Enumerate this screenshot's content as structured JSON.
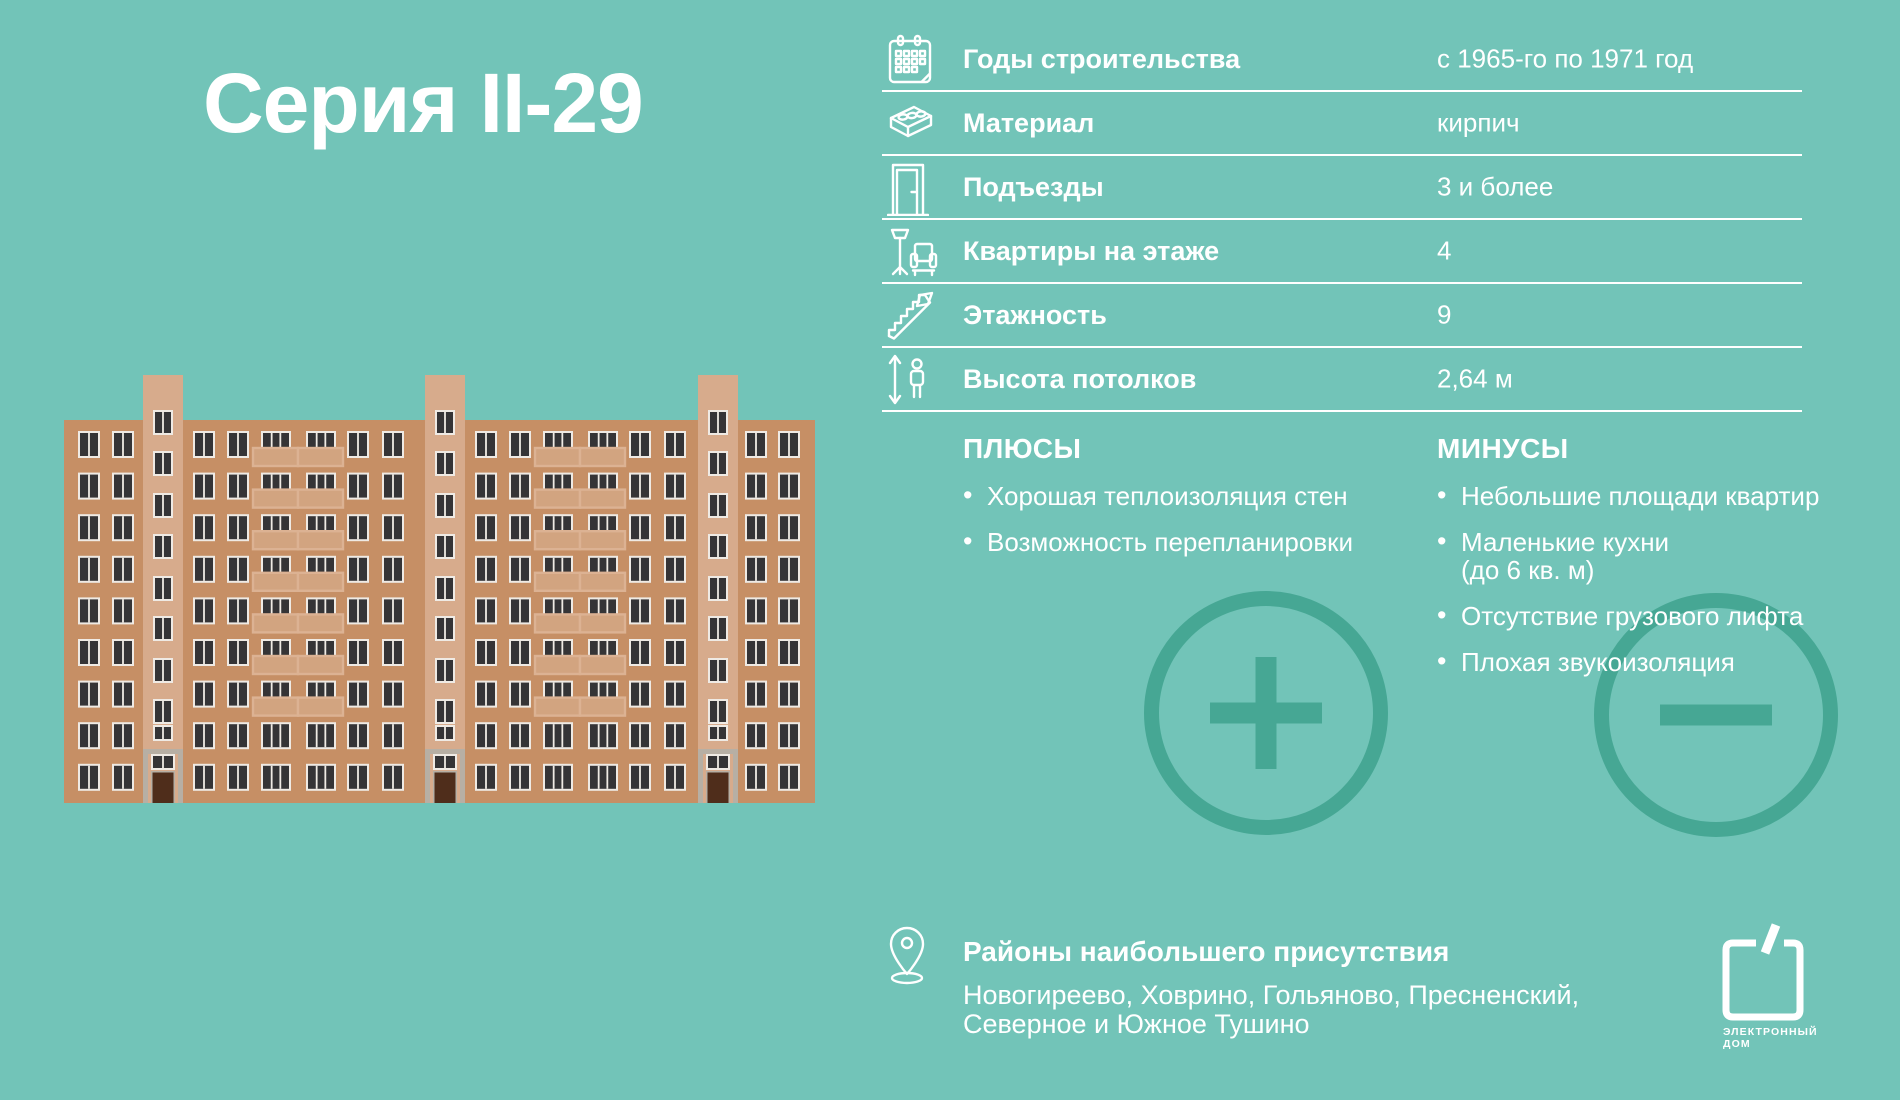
{
  "title": "Серия II-29",
  "specs": {
    "rows": [
      {
        "icon": "calendar-icon",
        "label": "Годы строительства",
        "value": "с 1965-го по 1971 год"
      },
      {
        "icon": "brick-icon",
        "label": "Материал",
        "value": "кирпич"
      },
      {
        "icon": "door-icon",
        "label": "Подъезды",
        "value": "3 и более"
      },
      {
        "icon": "furniture-icon",
        "label": "Квартиры на этаже",
        "value": "4"
      },
      {
        "icon": "stairs-icon",
        "label": "Этажность",
        "value": "9"
      },
      {
        "icon": "height-icon",
        "label": "Высота потолков",
        "value": "2,64 м"
      }
    ]
  },
  "pros": {
    "heading": "ПЛЮСЫ",
    "items": [
      "Хорошая теплоизоляция стен",
      "Возможность перепланировки"
    ]
  },
  "cons": {
    "heading": "МИНУСЫ",
    "items": [
      [
        "Небольшие площади квартир"
      ],
      [
        "Маленькие кухни",
        "(до 6 кв. м)"
      ],
      [
        "Отсутствие грузового лифта"
      ],
      [
        "Плохая звукоизоляция"
      ]
    ]
  },
  "districts": {
    "heading": "Районы наибольшего присутствия",
    "lines": [
      "Новогиреево, Ховрино, Гольяново, Пресненский,",
      "Северное и Южное Тушино"
    ]
  },
  "logo": {
    "line1": "ЭЛЕКТРОННЫЙ",
    "line2": "ДОМ"
  },
  "colors": {
    "background": "#72c4b8",
    "accent_circle": "#46a794",
    "text": "#ffffff",
    "facade": "#c68f65",
    "tower": "#d7ab8c",
    "balcony": "#d2a480",
    "balcony_edge": "#dcb293",
    "window_glass": "#353436",
    "window_frame": "#efeae4",
    "door": "#4f2d1b",
    "entrance_gray": "#b7afa4"
  }
}
